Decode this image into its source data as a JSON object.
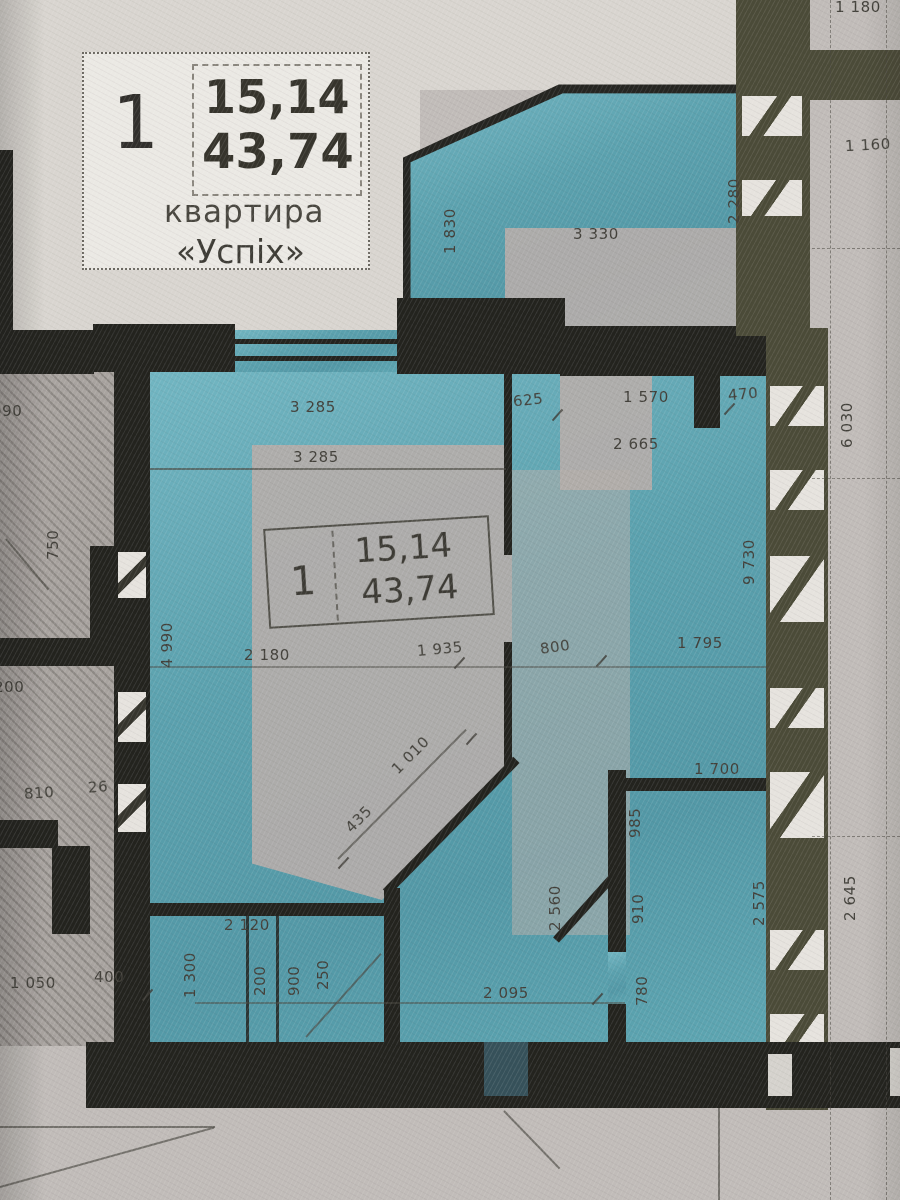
{
  "legend": {
    "number": "1",
    "area_living": "15,14",
    "area_total": "43,74",
    "caption_line1": "квартира",
    "caption_line2": "«Успіх»"
  },
  "unit_box": {
    "number": "1",
    "area_living": "15,14",
    "area_total": "43,74"
  },
  "dims": {
    "d1180": "1 180",
    "d1160": "1 160",
    "d1830": "1 830",
    "d3330": "3 330",
    "d2280": "2 280",
    "d3285a": "3 285",
    "d3285b": "3 285",
    "d625": "625",
    "d1570": "1 570",
    "d470": "470",
    "d2665": "2 665",
    "d6030": "6 030",
    "d9730": "9 730",
    "d990": "990",
    "d750": "750",
    "d4990": "4 990",
    "d2180": "2 180",
    "d1935": "1 935",
    "d800": "800",
    "d1795": "1 795",
    "d200a": "200",
    "d810": "810",
    "d26": "26",
    "d1010": "1 010",
    "d435": "435",
    "d1050": "1 050",
    "d400": "400",
    "d2120": "2 120",
    "d1300": "1 300",
    "d200b": "200",
    "d900": "900",
    "d250": "250",
    "d2095": "2 095",
    "d2560": "2 560",
    "d985": "985",
    "d910": "910",
    "d780": "780",
    "d1700": "1 700",
    "d2575": "2 575",
    "d2645": "2 645"
  },
  "colors": {
    "highlight_teal": "#55a3b2",
    "wall_dark": "#20201b",
    "wall_olive": "#4a4934",
    "paper": "#dcd8d2",
    "room_fill": "#b6aeaa"
  }
}
